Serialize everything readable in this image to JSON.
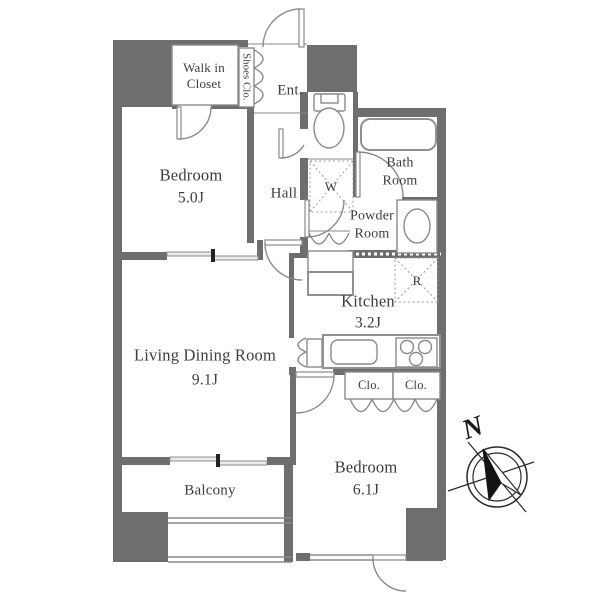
{
  "title": "apartment floor plan",
  "rooms": {
    "walk_in_closet": {
      "name": "Walk in Closet"
    },
    "shoes_closet": {
      "name": "Shoes Clo."
    },
    "entrance": {
      "name": "Ent."
    },
    "bedroom1": {
      "name": "Bedroom",
      "size": "5.0J"
    },
    "hall": {
      "name": "Hall"
    },
    "bath": {
      "name": "Bath Room"
    },
    "powder": {
      "name": "Powder Room"
    },
    "kitchen": {
      "name": "Kitchen",
      "size": "3.2J"
    },
    "living": {
      "name": "Living Dining Room",
      "size": "9.1J"
    },
    "bedroom2": {
      "name": "Bedroom",
      "size": "6.1J"
    },
    "balcony": {
      "name": "Balcony"
    },
    "closet1": {
      "name": "Clo."
    },
    "closet2": {
      "name": "Clo."
    }
  },
  "fixtures": {
    "washer_space": {
      "label": "W"
    },
    "refrigerator_space": {
      "label": "R"
    }
  },
  "compass": {
    "label": "N"
  },
  "colors": {
    "wall": "#6e6e6e",
    "line": "#8a8a8a",
    "text": "#3d3d3d",
    "ink": "#1c1c1c",
    "bg": "#ffffff"
  }
}
